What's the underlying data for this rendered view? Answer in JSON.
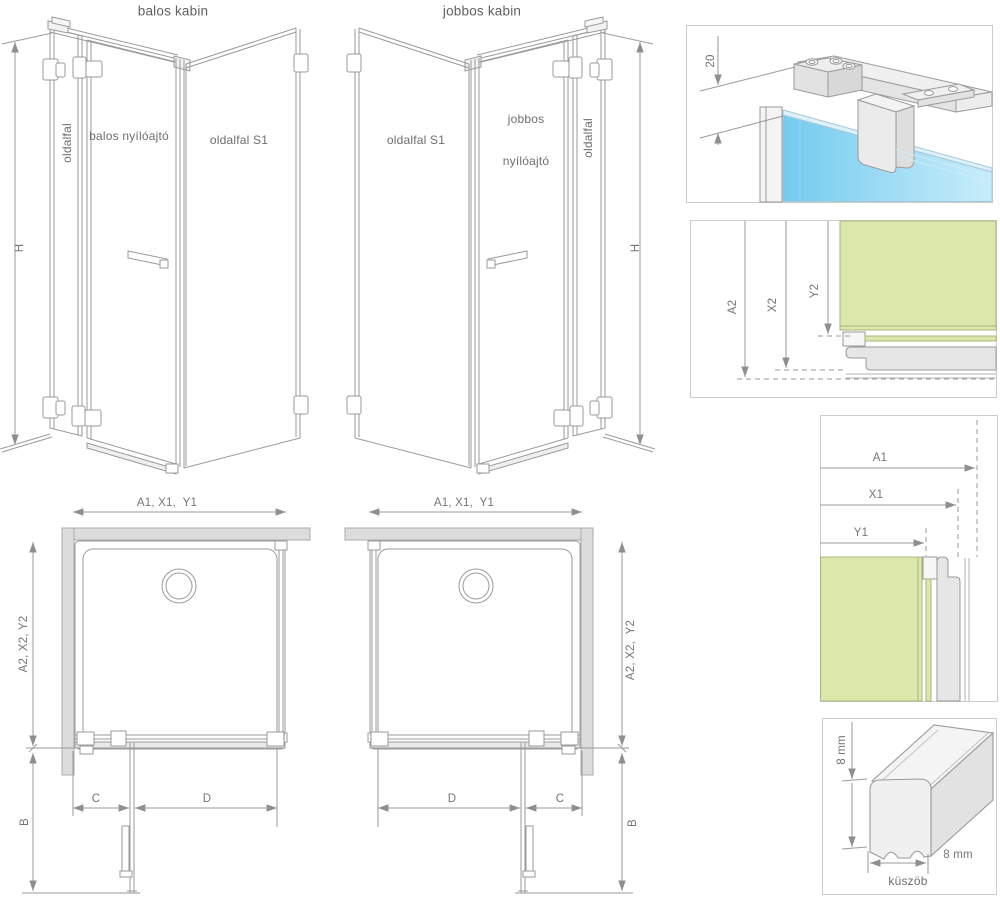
{
  "cabins": {
    "left": {
      "title": "balos kabin",
      "side_wall_label": "oldalfal",
      "door_label": "balos nyílóajtó",
      "side_panel_label": "oldalfal S1",
      "height_label": "H"
    },
    "right": {
      "title": "jobbos kabin",
      "side_panel_label": "oldalfal S1",
      "door_label_line1": "jobbos",
      "door_label_line2": "nyílóajtó",
      "side_wall_label": "oldalfal",
      "height_label": "H"
    }
  },
  "plans": {
    "left": {
      "width_dims": "A1, X1,  Y1",
      "depth_dims": "A2, X2, Y2",
      "door_open_depth": "B",
      "fixed_width": "C",
      "door_width": "D"
    },
    "right": {
      "width_dims": "A1, X1,  Y1",
      "depth_dims": "A2, X2,  Y2",
      "door_open_depth": "B",
      "fixed_width": "C",
      "door_width": "D"
    }
  },
  "details": {
    "top_bar": {
      "offset_dim": "20"
    },
    "corner_depth": {
      "dim_a2": "A2",
      "dim_x2": "X2",
      "dim_y2": "Y2"
    },
    "corner_width": {
      "dim_a1": "A1",
      "dim_x1": "X1",
      "dim_y1": "Y1"
    },
    "threshold": {
      "height_dim": "8 mm",
      "width_dim": "8 mm",
      "caption": "küszöb"
    }
  },
  "colors": {
    "glass_blue_start": "#74cbef",
    "glass_blue_end": "#c8edfb",
    "glass_green": "#dbe8ab",
    "green_edge": "#a9b47e",
    "wall_gray": "#dcdcdc",
    "profile_gray": "#e6e6e6",
    "line_gray": "#9a9a9a",
    "text_gray": "#6e6e6e"
  }
}
